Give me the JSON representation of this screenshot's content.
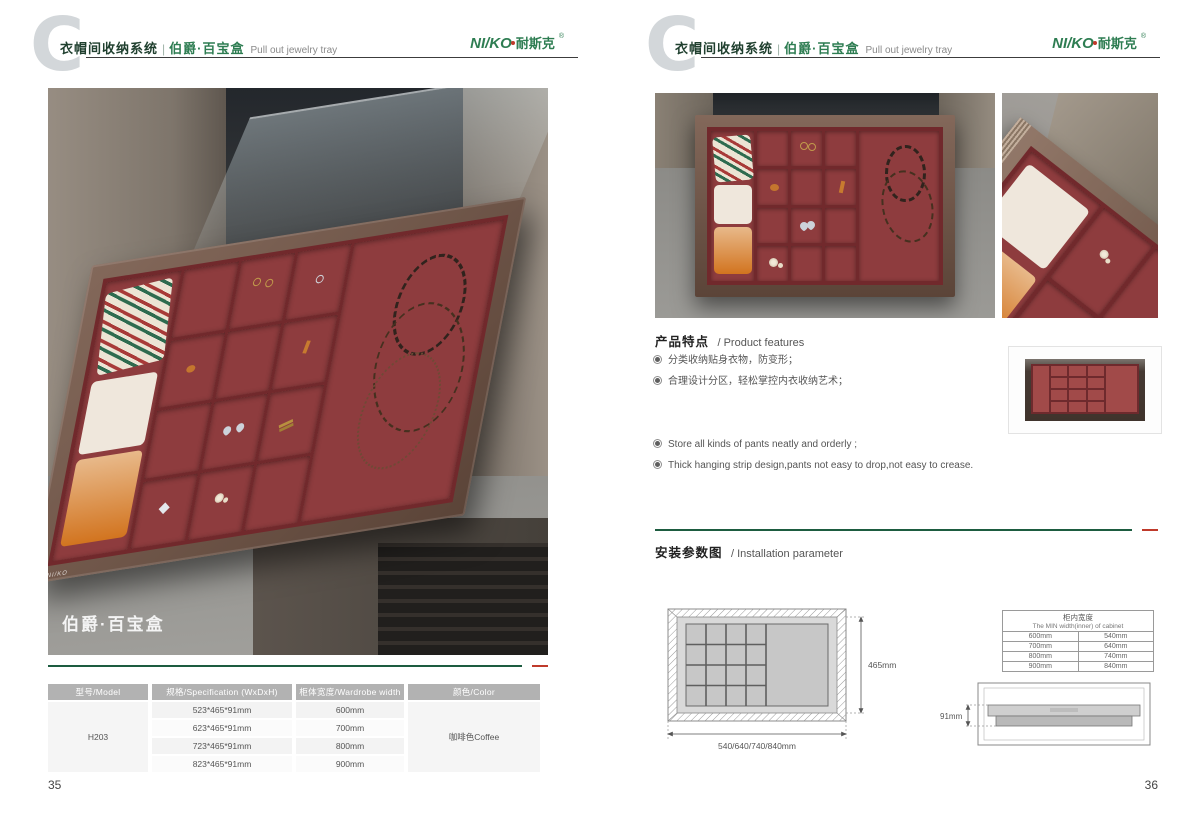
{
  "header": {
    "letter": "C",
    "series_cn": "衣帽间收纳系统",
    "divider": "|",
    "product_cn": "伯爵·百宝盒",
    "product_en": "Pull out jewelry tray",
    "logo": {
      "latin": "NI/KO",
      "cjk": "耐斯克",
      "reg": "®"
    }
  },
  "colors": {
    "brand_green": "#2e7d52",
    "rule_green": "#1d5c40",
    "accent_red": "#bf3a2b",
    "velvet_red": "#8e3c3e",
    "frame_bronze": "#6d5144",
    "table_header_gray": "#b2b2b2"
  },
  "page_left": {
    "number": "35",
    "photo_label": "伯爵·百宝盒",
    "spec_table": {
      "headers": [
        "型号/Model",
        "规格/Specification (WxDxH)",
        "柜体宽度/Wardrobe width",
        "颜色/Color"
      ],
      "model": "H203",
      "color": "咖啡色Coffee",
      "rows": [
        {
          "spec": "523*465*91mm",
          "width": "600mm"
        },
        {
          "spec": "623*465*91mm",
          "width": "700mm"
        },
        {
          "spec": "723*465*91mm",
          "width": "800mm"
        },
        {
          "spec": "823*465*91mm",
          "width": "900mm"
        }
      ]
    }
  },
  "page_right": {
    "number": "36",
    "features": {
      "title_cn": "产品特点",
      "title_en": "/ Product features",
      "items_cn": [
        "分类收纳贴身衣物，防变形；",
        "合理设计分区，轻松掌控内衣收纳艺术；"
      ],
      "items_en": [
        "Store all kinds of pants neatly and orderly ;",
        "Thick hanging strip design,pants not easy to drop,not easy to crease."
      ]
    },
    "installation": {
      "title_cn": "安装参数图",
      "title_en": "/ Installation parameter",
      "top_view": {
        "depth_dim": "465mm",
        "width_dim": "540/640/740/840mm"
      },
      "min_width_table": {
        "title_cn": "柜内宽度",
        "title_en": "The MIN width(inner) of cabinet",
        "rows": [
          [
            "600mm",
            "540mm"
          ],
          [
            "700mm",
            "640mm"
          ],
          [
            "800mm",
            "740mm"
          ],
          [
            "900mm",
            "840mm"
          ]
        ]
      },
      "side_view": {
        "height_dim": "91mm"
      }
    }
  }
}
